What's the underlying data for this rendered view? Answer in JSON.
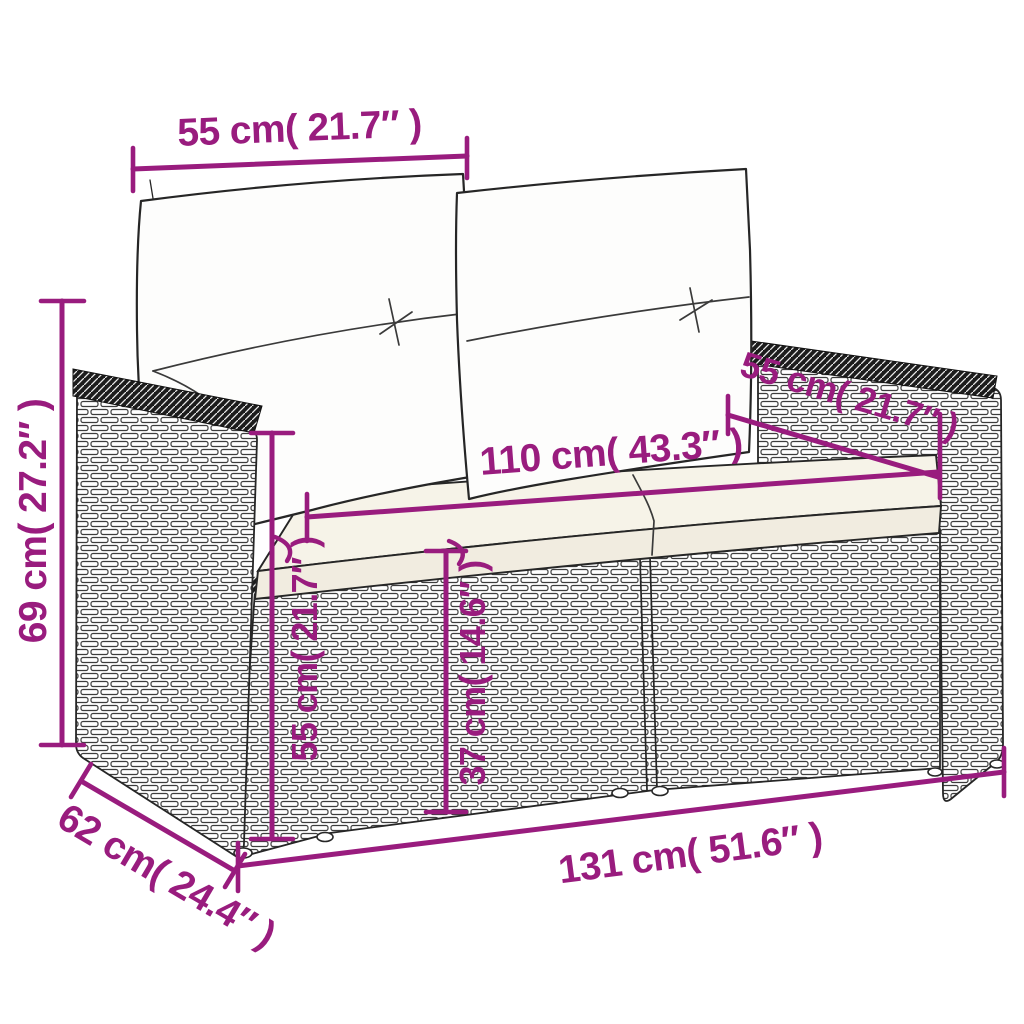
{
  "diagram": {
    "kind": "product-dimension-diagram",
    "subject": "poly-rattan 2-seater garden sofa with back and seat cushions"
  },
  "style": {
    "accent": "#991c7e",
    "artline": "#262626",
    "cushion_fill": "#fdfdfc",
    "seat_fill": "#f6f3e8",
    "seat_front_fill": "#f1ece0",
    "background": "#ffffff"
  },
  "dimensions": {
    "backrest_width": {
      "label": "55 cm( 21.7″ )",
      "value_cm": "55",
      "value_in": "21.7"
    },
    "overall_height": {
      "label": "69 cm( 27.2″ )",
      "value_cm": "69",
      "value_in": "27.2"
    },
    "seat_width": {
      "label": "110 cm( 43.3″ )",
      "value_cm": "110",
      "value_in": "43.3"
    },
    "armrest_depth": {
      "label": "55 cm( 21.7″ )",
      "value_cm": "55",
      "value_in": "21.7"
    },
    "armrest_height": {
      "label": "55 cm( 21.7″ )",
      "value_cm": "55",
      "value_in": "21.7"
    },
    "seat_height": {
      "label": "37 cm( 14.6″ )",
      "value_cm": "37",
      "value_in": "14.6"
    },
    "overall_width": {
      "label": "131 cm( 51.6″ )",
      "value_cm": "131",
      "value_in": "51.6"
    },
    "overall_depth": {
      "label": "62 cm( 24.4″ )",
      "value_cm": "62",
      "value_in": "24.4"
    }
  }
}
